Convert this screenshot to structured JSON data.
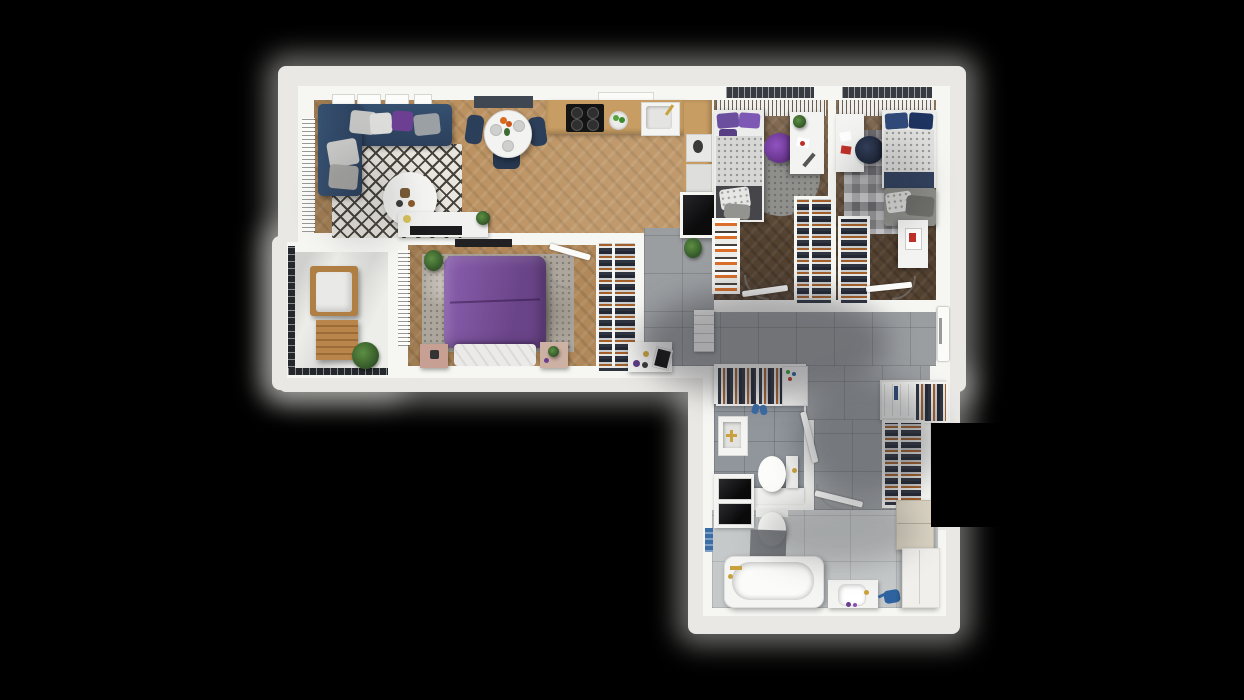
{
  "scene": {
    "type": "apartment-floor-plan-3d-top-view",
    "background": "black",
    "rooms": [
      {
        "name": "living-room-kitchen",
        "floor": "light-herringbone-wood",
        "furniture": [
          "corner-sofa-navy",
          "throw-pillows",
          "diamond-pattern-rug",
          "round-coffee-table",
          "tv-sideboard",
          "dining-table-round",
          "dining-chairs-navy",
          "kitchen-counter",
          "cooktop",
          "fruit-bowl",
          "kitchen-sink",
          "coffee-machine",
          "built-in-oven"
        ]
      },
      {
        "name": "kids-bedroom-1",
        "floor": "dark-herringbone-wood",
        "furniture": [
          "single-bed-purple-pillows",
          "round-gray-rug",
          "purple-bean-bag",
          "white-desk",
          "bookshelf",
          "open-wardrobe"
        ]
      },
      {
        "name": "kids-bedroom-2",
        "floor": "dark-herringbone-wood",
        "furniture": [
          "single-bed-blue-pillows",
          "gray-bench",
          "chevron-rug",
          "navy-pouf",
          "white-desk",
          "open-wardrobe",
          "white-cabinet-red-art"
        ]
      },
      {
        "name": "master-bedroom",
        "floor": "herringbone-wood",
        "furniture": [
          "double-bed-purple",
          "marbled-rug",
          "nightstand-left",
          "nightstand-right",
          "wall-tv",
          "open-wardrobe",
          "potted-plant"
        ]
      },
      {
        "name": "balcony",
        "floor": "white-concrete",
        "furniture": [
          "lounge-chair",
          "slatted-wood-table",
          "potted-plant"
        ]
      },
      {
        "name": "hallway",
        "floor": "gray-tile",
        "furniture": [
          "potted-plant",
          "shoe-cabinet",
          "console-decor",
          "coat-rack",
          "corridor-closet-shelves",
          "corridor-closet-rail"
        ]
      },
      {
        "name": "wc",
        "floor": "gray-tile",
        "furniture": [
          "square-basin",
          "toilet",
          "counter",
          "washer",
          "dryer",
          "slippers"
        ]
      },
      {
        "name": "bathroom",
        "floor": "light-gray-tile",
        "furniture": [
          "toilet",
          "bath-mat",
          "bathtub",
          "vanity-sink",
          "watering-can",
          "beige-cabinet",
          "tall-cabinet",
          "towels"
        ]
      }
    ]
  },
  "palette": {
    "background": "#000000",
    "apron": "#e9e8e4",
    "wall": "#f6f6f3",
    "wood_light": "#bb9160",
    "wood_master": "#b0885a",
    "wood_dark": "#6a533d",
    "tile_hall": "#9b9ea1",
    "tile_bath": "#c6c9ca",
    "tile_wc": "#90969c",
    "balcony_floor": "#ededea",
    "sofa_navy": "#2f4663",
    "chair_navy": "#2c3f5a",
    "bed_purple": "#71478f",
    "pillow_purple": "#8a4fb5",
    "beanbag_purple": "#7b3fa3",
    "pouf_navy": "#232c3e",
    "gold": "#c9a23f",
    "appliance_black": "#0f0f10",
    "cabinet_beige": "#d9d2c2",
    "plant_green": "#3e6b34",
    "blue_item": "#3b6da6",
    "art_red": "#c03028"
  }
}
